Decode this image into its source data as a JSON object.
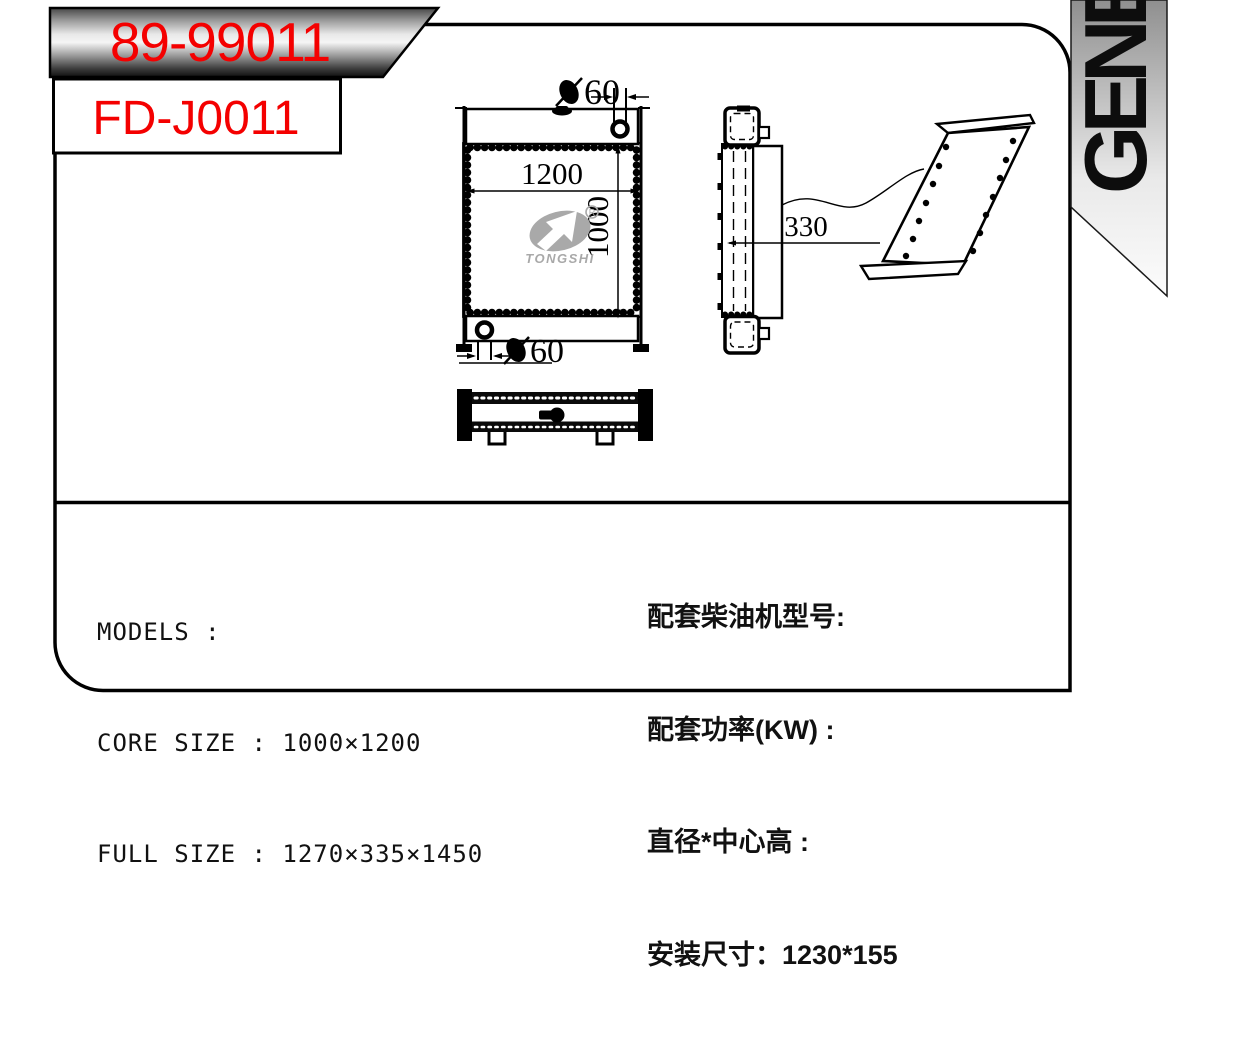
{
  "banners": {
    "primary": "89-99011",
    "secondary": "FD-J0011"
  },
  "ribbon": {
    "text": "GENE"
  },
  "colors": {
    "accent_red": "#f40000",
    "line_black": "#000000",
    "logo_gray": "#a9a9a9",
    "ribbon_gray_top": "#8f8f8f"
  },
  "drawing": {
    "dimensions": {
      "core_width": "1200",
      "core_height": "1000",
      "depth": "330",
      "inlet_diameter": "60",
      "outlet_diameter": "60"
    },
    "logo": {
      "brand": "TONGSHI",
      "registered_mark": "R"
    }
  },
  "specs": {
    "left_lines": [
      "MODELS :",
      "CORE SIZE : 1000×1200",
      "FULL SIZE : 1270×335×1450"
    ],
    "right_lines": [
      "配套柴油机型号:",
      "配套功率(KW) :",
      "直径*中心高 :",
      "安装尺寸：1230*155"
    ]
  }
}
